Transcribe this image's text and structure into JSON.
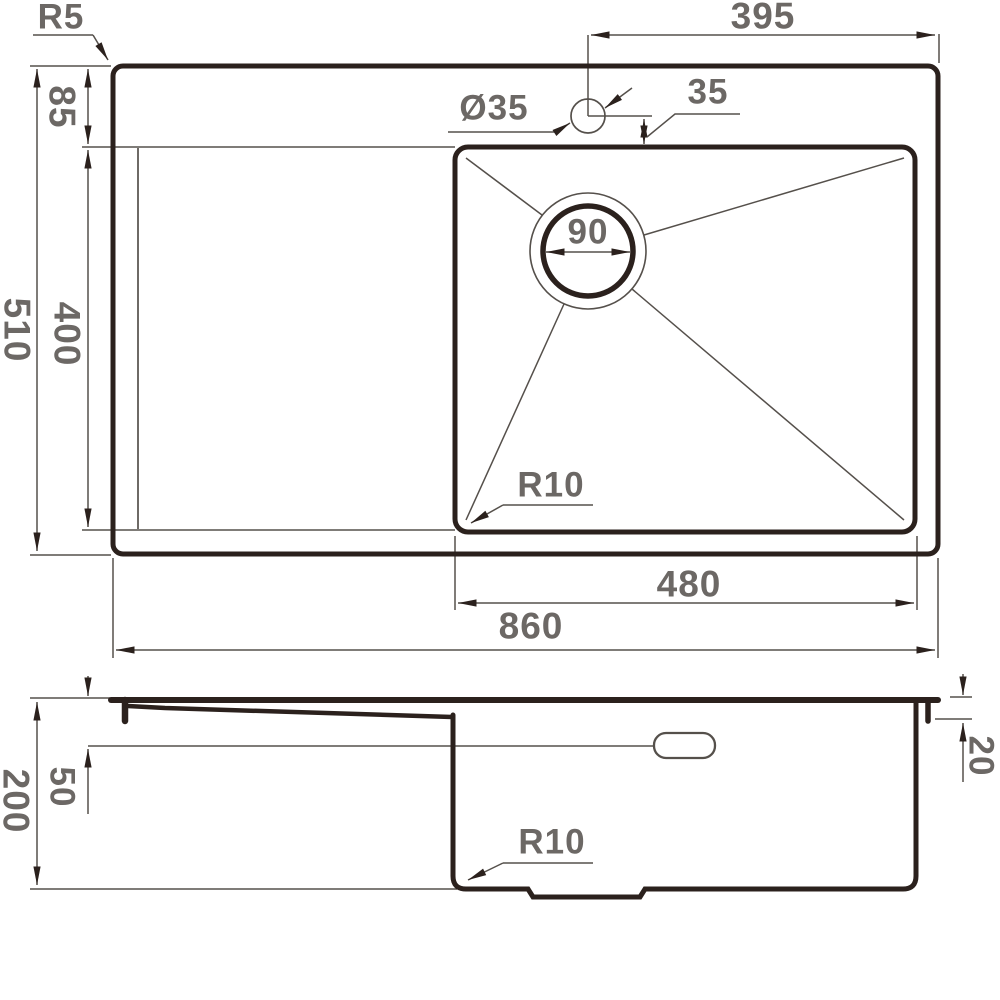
{
  "colors": {
    "background": "#ffffff",
    "thick_line": "#2b211d",
    "thin_line": "#55504b",
    "label_text": "#6c6865"
  },
  "top_view": {
    "labels": {
      "corner_radius": "R5",
      "faucet_offset_right": "395",
      "rim_to_bowl_gap": "85",
      "faucet_hole_diameter": "Ø35",
      "faucet_to_bowl_offset": "35",
      "drain_diameter": "90",
      "overall_depth": "510",
      "bowl_depth": "400",
      "bowl_corner_radius": "R10",
      "bowl_width": "480",
      "overall_width": "860"
    }
  },
  "side_view": {
    "labels": {
      "overall_height": "200",
      "overflow_offset": "50",
      "rim_lip_depth": "20",
      "bottom_corner_radius": "R10"
    }
  }
}
